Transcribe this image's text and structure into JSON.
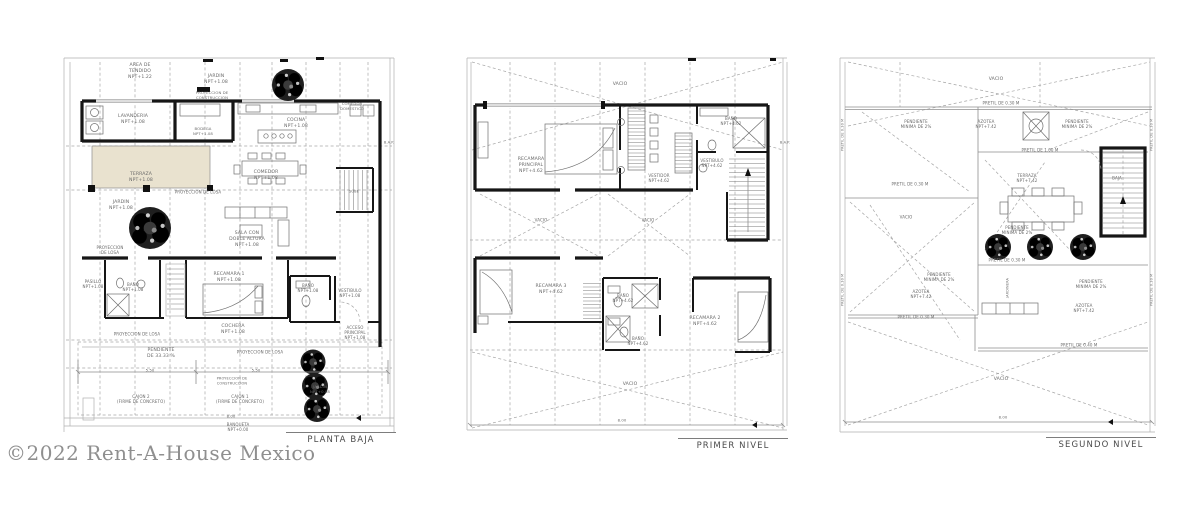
{
  "watermark": "©2022 Rent-A-House Mexico",
  "colors": {
    "paper": "#ffffff",
    "wall": "#161616",
    "label": "#6a6a6a",
    "title": "#4a4a4a",
    "watermark": "#8f8f8f",
    "terrace_fill": "#e9e2cf"
  },
  "plans": [
    {
      "title": "PLANTA BAJA",
      "labels": [
        {
          "t": "AREA DE\nTENDIDO\nNPT+1.22",
          "x": 140,
          "y": 72
        },
        {
          "t": "JARDIN\nNPT+1.08",
          "x": 216,
          "y": 80
        },
        {
          "t": "PROYECCION DE\nCONSTRUCCION",
          "x": 212,
          "y": 96,
          "s": 3.8
        },
        {
          "t": "LAVANDERIA\nNPT+1.08",
          "x": 133,
          "y": 120
        },
        {
          "t": "BODEGA\nNPT+1.08",
          "x": 203,
          "y": 132,
          "s": 3.8
        },
        {
          "t": "COCINA\nNPT+1.08",
          "x": 296,
          "y": 124
        },
        {
          "t": "COMEDOR\nDOMESTICO",
          "x": 352,
          "y": 107,
          "s": 3.8
        },
        {
          "t": "B.A.P.",
          "x": 389,
          "y": 143,
          "s": 3.5
        },
        {
          "t": "TERRAZA\nNPT+1.08",
          "x": 141,
          "y": 178
        },
        {
          "t": "PROYECCION DE LOSA",
          "x": 198,
          "y": 192,
          "s": 4
        },
        {
          "t": "JARDIN\nNPT+1.08",
          "x": 121,
          "y": 206
        },
        {
          "t": "COMEDOR\nNPT+1.08",
          "x": 266,
          "y": 176
        },
        {
          "t": "SALA CON\nDOBLE ALTURA\nNPT+1.08",
          "x": 247,
          "y": 240
        },
        {
          "t": "SUBE",
          "x": 354,
          "y": 192,
          "s": 3.5
        },
        {
          "t": "PROYECCION\nDE LOSA",
          "x": 110,
          "y": 250,
          "s": 4
        },
        {
          "t": "PASILLO\nNPT+1.08",
          "x": 93,
          "y": 284,
          "s": 4
        },
        {
          "t": "BAÑO\nNPT+1.08",
          "x": 133,
          "y": 287,
          "s": 4
        },
        {
          "t": "RECAMARA 1\nNPT+1.08",
          "x": 229,
          "y": 278
        },
        {
          "t": "BAÑO\nNPT+1.08",
          "x": 308,
          "y": 288,
          "s": 4
        },
        {
          "t": "VESTIBULO\nNPT+1.08",
          "x": 350,
          "y": 293,
          "s": 4
        },
        {
          "t": "COCHERA\nNPT+1.08",
          "x": 233,
          "y": 330
        },
        {
          "t": "ACCESO\nPRINCIPAL\nNPT+1.08",
          "x": 355,
          "y": 333,
          "s": 4
        },
        {
          "t": "PROYECCION DE LOSA",
          "x": 137,
          "y": 334,
          "s": 4
        },
        {
          "t": "PENDIENTE\nDE 33.33 %",
          "x": 161,
          "y": 354
        },
        {
          "t": "PROYECCION DE LOSA",
          "x": 260,
          "y": 352,
          "s": 4
        },
        {
          "t": "5.50",
          "x": 150,
          "y": 371,
          "s": 3.8
        },
        {
          "t": "5.50",
          "x": 256,
          "y": 371,
          "s": 3.8
        },
        {
          "t": "PROYECCION DE\nCONSTRUCCION",
          "x": 232,
          "y": 381,
          "s": 3.6
        },
        {
          "t": "CAJON 2\n(FIRME DE CONCRETO)",
          "x": 141,
          "y": 399,
          "s": 4
        },
        {
          "t": "CAJON 1\n(FIRME DE CONCRETO)",
          "x": 240,
          "y": 399,
          "s": 4
        },
        {
          "t": "JARDIN\nNPT+0.08",
          "x": 320,
          "y": 390,
          "s": 3.8
        },
        {
          "t": "8.00",
          "x": 231,
          "y": 417,
          "s": 3.8
        },
        {
          "t": "BANQUETA\nNPT+0.00",
          "x": 238,
          "y": 427,
          "s": 4
        }
      ]
    },
    {
      "title": "PRIMER NIVEL",
      "labels": [
        {
          "t": "VACIO",
          "x": 620,
          "y": 85
        },
        {
          "t": "RECAMARA\nPRINCIPAL\nNPT+4.62",
          "x": 531,
          "y": 166
        },
        {
          "t": "VESTIDOR\nNPT+4.62",
          "x": 659,
          "y": 178,
          "s": 4
        },
        {
          "t": "BAÑO\nNPT+4.62",
          "x": 731,
          "y": 121,
          "s": 4
        },
        {
          "t": "VESTIBULO\nNPT+4.62",
          "x": 712,
          "y": 163,
          "s": 4
        },
        {
          "t": "B.A.P.",
          "x": 785,
          "y": 143,
          "s": 3.5
        },
        {
          "t": "VACIO",
          "x": 541,
          "y": 220,
          "s": 4
        },
        {
          "t": "VACIO",
          "x": 648,
          "y": 220,
          "s": 4
        },
        {
          "t": "RECAMARA 3\nNPT+4.62",
          "x": 551,
          "y": 290
        },
        {
          "t": "BAÑO\nNPT+4.62",
          "x": 623,
          "y": 298,
          "s": 4
        },
        {
          "t": "BAÑO\nNPT+4.62",
          "x": 638,
          "y": 341,
          "s": 4
        },
        {
          "t": "RECAMARA 2\nNPT+4.62",
          "x": 705,
          "y": 322
        },
        {
          "t": "VACIO",
          "x": 630,
          "y": 385
        },
        {
          "t": "8.00",
          "x": 622,
          "y": 421,
          "s": 3.8
        }
      ]
    },
    {
      "title": "SEGUNDO NIVEL",
      "labels": [
        {
          "t": "VACIO",
          "x": 996,
          "y": 80
        },
        {
          "t": "PRETIL DE 0.30 M",
          "x": 1001,
          "y": 103,
          "s": 4
        },
        {
          "t": "PENDIENTE\nMINIMA DE 2%",
          "x": 916,
          "y": 124,
          "s": 4
        },
        {
          "t": "AZOTEA\nNPT+7.42",
          "x": 986,
          "y": 124,
          "s": 4
        },
        {
          "t": "PENDIENTE\nMINIMA DE 2%",
          "x": 1077,
          "y": 124,
          "s": 4
        },
        {
          "t": "PRETIL DE 1.00 M",
          "x": 1040,
          "y": 150,
          "s": 4
        },
        {
          "t": "TERRAZA\nNPT+7.42",
          "x": 1027,
          "y": 178,
          "s": 4
        },
        {
          "t": "BAJA",
          "x": 1117,
          "y": 178,
          "s": 4
        },
        {
          "t": "PRETIL DE 0.30 M",
          "x": 910,
          "y": 184,
          "s": 4
        },
        {
          "t": "VACIO",
          "x": 906,
          "y": 217,
          "s": 4
        },
        {
          "t": "PENDIENTE\nMINIMA DE 2%",
          "x": 1017,
          "y": 230,
          "s": 4
        },
        {
          "t": "PRETIL DE 0.30 M",
          "x": 1007,
          "y": 260,
          "s": 4
        },
        {
          "t": "PENDIENTE\nMINIMA DE 2%",
          "x": 939,
          "y": 277,
          "s": 4
        },
        {
          "t": "AZOTEA\nNPT+7.42",
          "x": 921,
          "y": 294,
          "s": 4
        },
        {
          "t": "JARDINERA",
          "x": 1008,
          "y": 288,
          "s": 3.5,
          "r": -90
        },
        {
          "t": "PENDIENTE\nMINIMA DE 2%",
          "x": 1091,
          "y": 284,
          "s": 4
        },
        {
          "t": "AZOTEA\nNPT+7.42",
          "x": 1084,
          "y": 308,
          "s": 4
        },
        {
          "t": "PRETIL DE 0.30 M",
          "x": 916,
          "y": 317,
          "s": 4
        },
        {
          "t": "PRETIL DE 0.40 M",
          "x": 1079,
          "y": 345,
          "s": 4
        },
        {
          "t": "VACIO",
          "x": 1001,
          "y": 380
        },
        {
          "t": "8.00",
          "x": 1003,
          "y": 418,
          "s": 3.8
        },
        {
          "t": "PRETIL DE 0.30 M",
          "x": 843,
          "y": 135,
          "s": 3.5,
          "r": -90
        },
        {
          "t": "PRETIL DE 0.30 M",
          "x": 843,
          "y": 290,
          "s": 3.5,
          "r": -90
        },
        {
          "t": "PRETIL DE 0.30 M",
          "x": 1152,
          "y": 135,
          "s": 3.5,
          "r": -90
        },
        {
          "t": "PRETIL DE 0.30 M",
          "x": 1152,
          "y": 290,
          "s": 3.5,
          "r": -90
        }
      ]
    }
  ]
}
